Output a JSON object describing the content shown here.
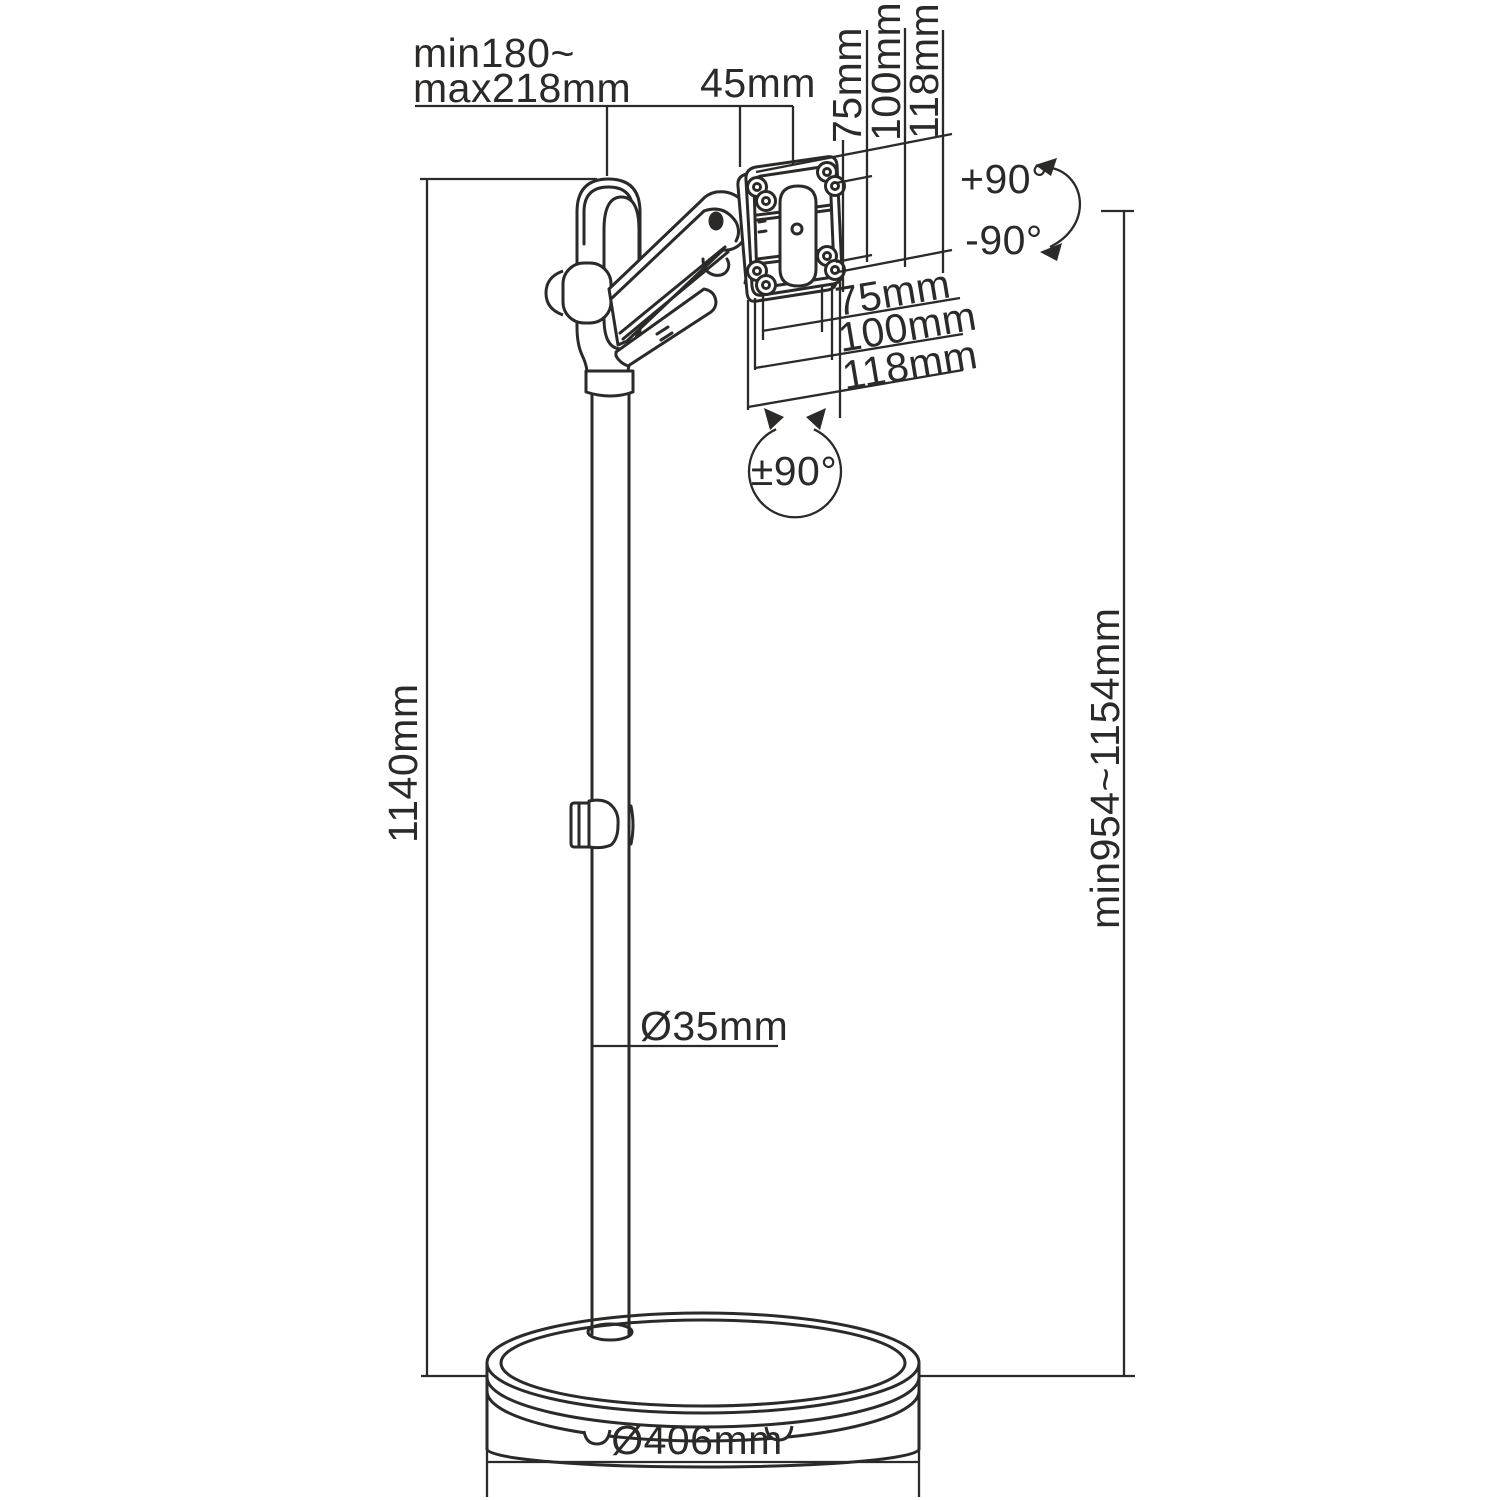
{
  "page": {
    "colors": {
      "ink": "#2b2a29",
      "background": "#ffffff"
    }
  },
  "diagram": {
    "labels": {
      "arm_reach": {
        "line1": "min180~",
        "line2": "max218mm"
      },
      "head_depth": "45mm",
      "vesa_vertical": [
        "75mm",
        "100mm",
        "118mm"
      ],
      "vesa_horizontal": [
        "75mm",
        "100mm",
        "118mm"
      ],
      "tilt": {
        "plus": "+90°",
        "minus": "-90°"
      },
      "swivel": "±90°",
      "pole_height": "1140mm",
      "pole_diameter": "Ø35mm",
      "height_range": "min954~1154mm",
      "base_diameter": "Ø406mm"
    }
  }
}
